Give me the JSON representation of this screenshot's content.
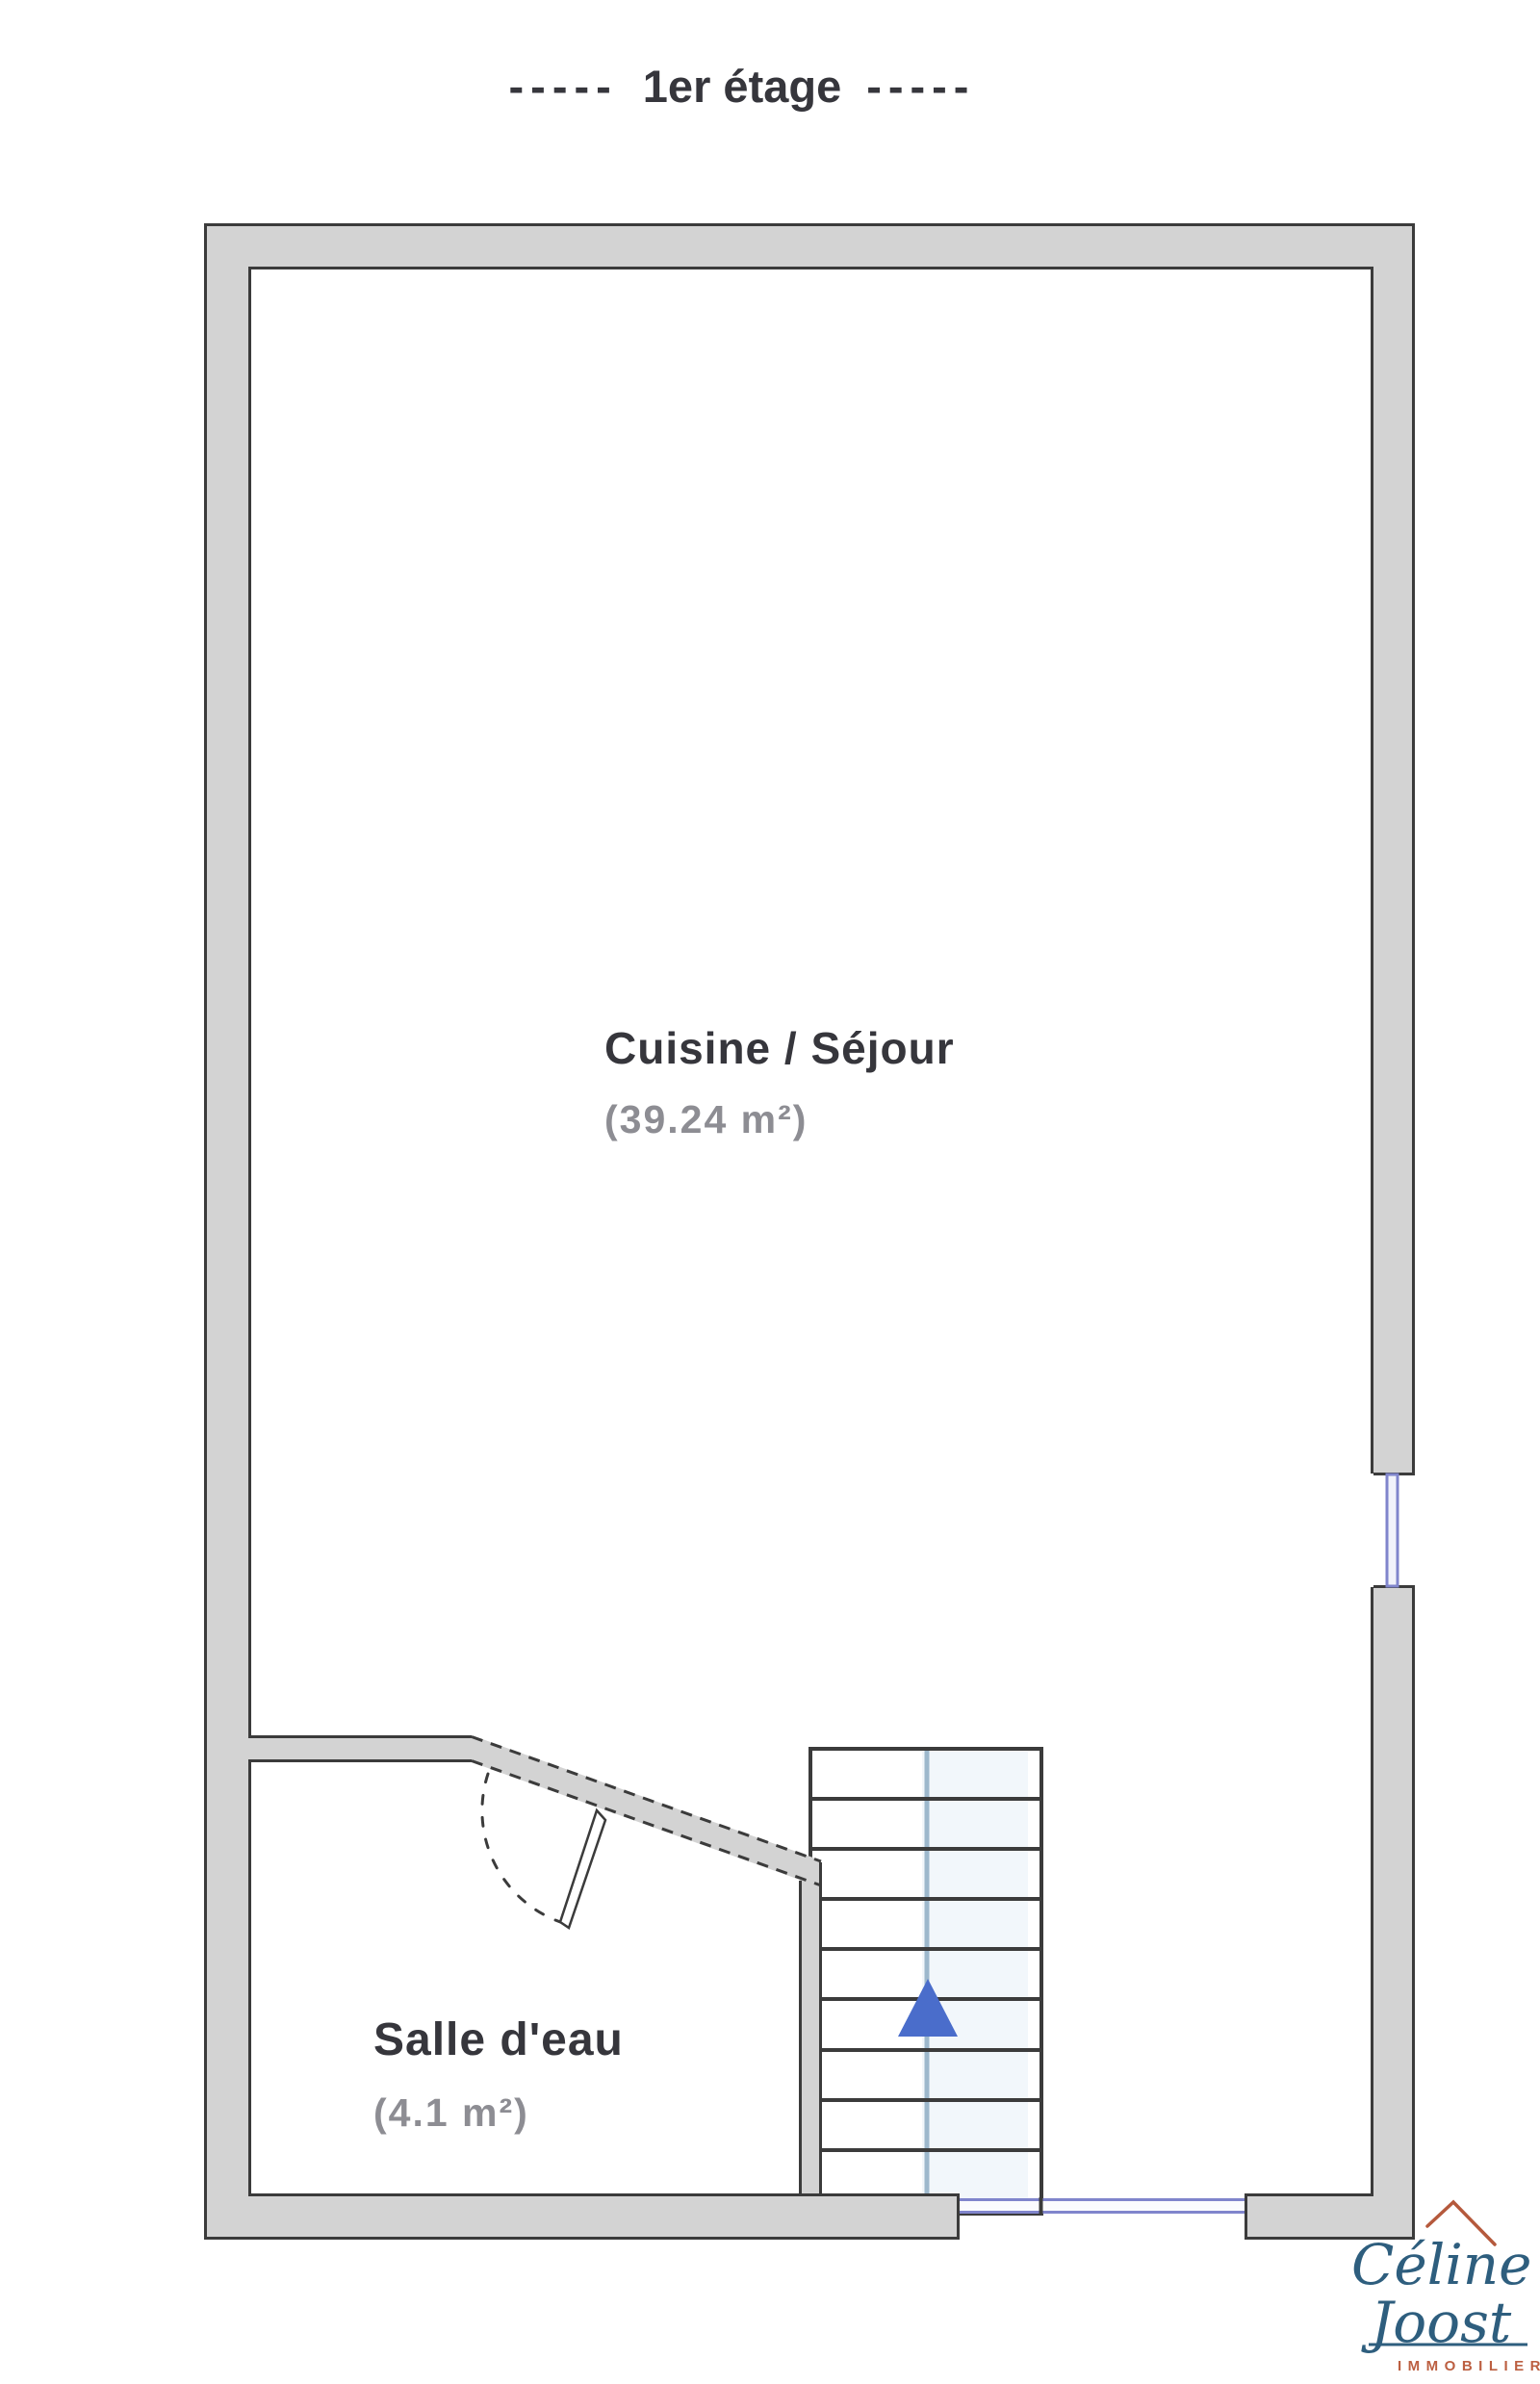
{
  "title": {
    "dashes": "-----",
    "text": "1er étage"
  },
  "rooms": [
    {
      "name": "Cuisine / Séjour",
      "area": "(39.24 m²)"
    },
    {
      "name": "Salle d'eau",
      "area": "(4.1 m²)"
    }
  ],
  "stairs": {
    "arrow_direction": "up"
  },
  "logo": {
    "name_line1": "Céline",
    "name_line2": "Joost",
    "tagline": "IMMOBILIER"
  },
  "colors": {
    "wall_fill": "#d3d3d3",
    "wall_outline": "#3b3b3b",
    "window_blue": "#8085cc",
    "stair_arrow_blue": "#4a6dcb",
    "stair_guide_blue": "#9db8cc",
    "logo_teal": "#2e5e7e",
    "logo_rust": "#b5593c",
    "label_dark": "#36363c",
    "label_gray": "#8d8d93"
  }
}
